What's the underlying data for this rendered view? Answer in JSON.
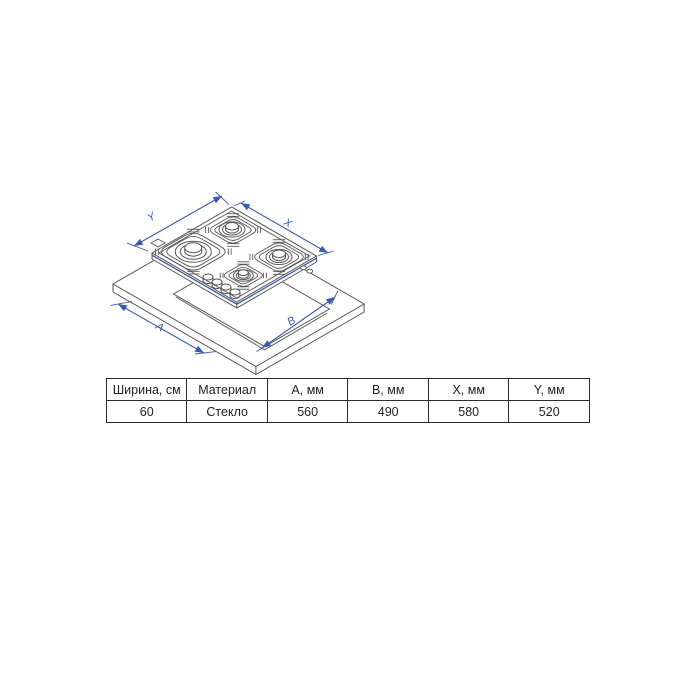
{
  "diagram": {
    "description": "isometric-line-drawing-gas-hob-over-countertop-cutout",
    "dimension_labels": {
      "y": "Y",
      "x": "X",
      "a": "A",
      "b": "B"
    },
    "colors": {
      "line": "#555555",
      "dimension": "#3d5ba8"
    }
  },
  "table": {
    "headers": [
      "Ширина, см",
      "Материал",
      "A, мм",
      "B, мм",
      "X, мм",
      "Y, мм"
    ],
    "values": [
      "60",
      "Стекло",
      "560",
      "490",
      "580",
      "520"
    ]
  }
}
